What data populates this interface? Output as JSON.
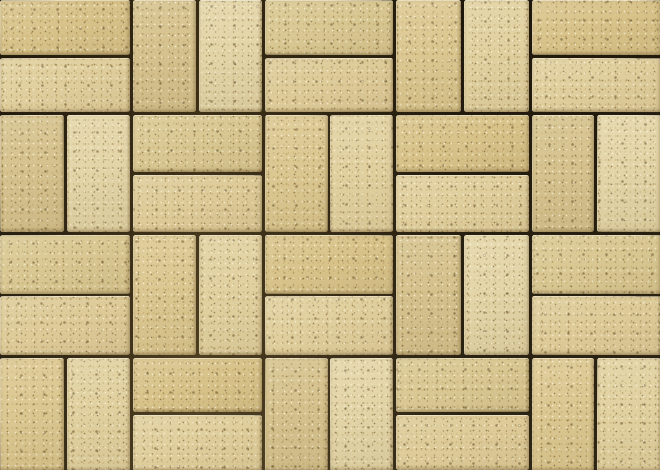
{
  "scene": {
    "type": "texture-photograph",
    "subject": "Sand-yellow concrete paver bricks laid in a basketweave pattern, photographed from directly above",
    "pattern": "basketweave",
    "grid": {
      "columns": 5,
      "rows": 4,
      "column_boundaries_px": [
        0,
        131,
        263,
        394,
        530,
        660
      ],
      "row_boundaries_px": [
        0,
        113,
        233,
        356,
        470
      ],
      "orientation_map": [
        [
          "H",
          "V",
          "H",
          "V",
          "H"
        ],
        [
          "V",
          "H",
          "V",
          "H",
          "V"
        ],
        [
          "H",
          "V",
          "H",
          "V",
          "H"
        ],
        [
          "V",
          "H",
          "V",
          "H",
          "V"
        ]
      ],
      "bricks_per_cell": 2,
      "total_bricks": 40,
      "joint_width_px": 3
    },
    "colors": {
      "joint_dark": "#46381c",
      "joint_mortar": "#6b5936",
      "speckle_light": "#f6eecd",
      "speckle_dark": "#8a7038",
      "edge_highlight": "#fdf9e8",
      "brick_tones": [
        "#e0cf9e",
        "#dbc791",
        "#e3d5a8",
        "#d8c38b",
        "#ddcb99",
        "#d5c28e",
        "#e1d1a1",
        "#d9c893"
      ]
    }
  }
}
